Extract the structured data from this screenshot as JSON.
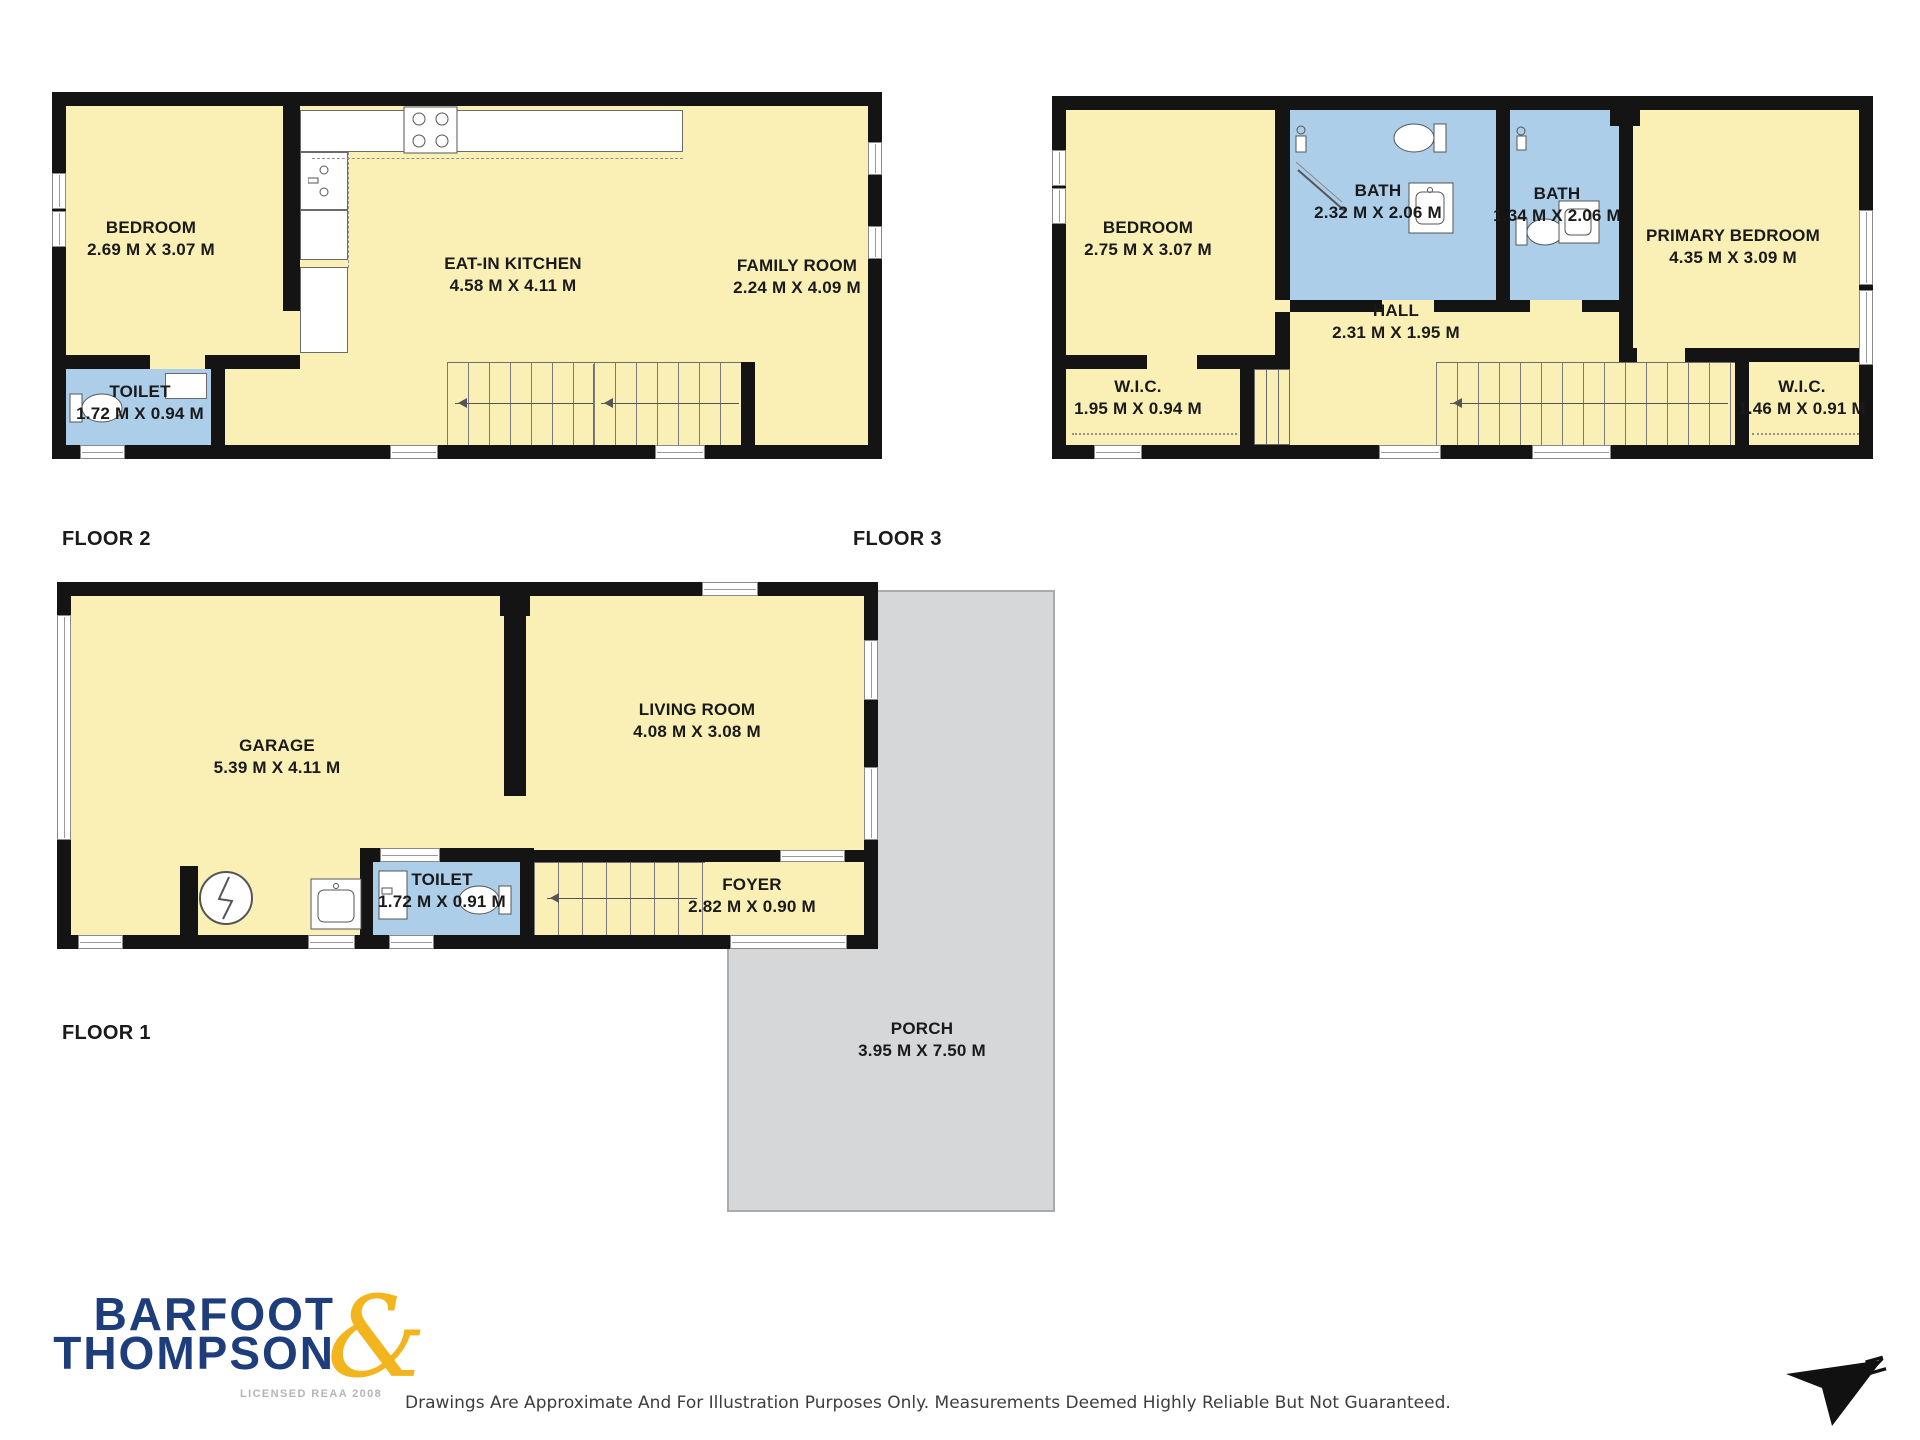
{
  "floor2": {
    "label": "FLOOR 2",
    "bedroom": {
      "name": "BEDROOM",
      "dims": "2.69 M X 3.07 M"
    },
    "kitchen": {
      "name": "EAT-IN KITCHEN",
      "dims": "4.58 M X 4.11 M"
    },
    "family": {
      "name": "FAMILY ROOM",
      "dims": "2.24 M X 4.09 M"
    },
    "toilet": {
      "name": "TOILET",
      "dims": "1.72 M X 0.94 M"
    }
  },
  "floor3": {
    "label": "FLOOR 3",
    "bedroom": {
      "name": "BEDROOM",
      "dims": "2.75 M X 3.07 M"
    },
    "bath1": {
      "name": "BATH",
      "dims": "2.32 M X 2.06 M"
    },
    "bath2": {
      "name": "BATH",
      "dims": "1.34 M X 2.06 M"
    },
    "primary": {
      "name": "PRIMARY BEDROOM",
      "dims": "4.35 M X 3.09 M"
    },
    "hall": {
      "name": "HALL",
      "dims": "2.31 M X 1.95 M"
    },
    "wic_left": {
      "name": "W.I.C.",
      "dims": "1.95 M X 0.94 M"
    },
    "wic_right": {
      "name": "W.I.C.",
      "dims": "1.46 M X 0.91 M"
    }
  },
  "floor1": {
    "label": "FLOOR 1",
    "garage": {
      "name": "GARAGE",
      "dims": "5.39 M X 4.11 M"
    },
    "living": {
      "name": "LIVING ROOM",
      "dims": "4.08 M X 3.08 M"
    },
    "toilet": {
      "name": "TOILET",
      "dims": "1.72 M X 0.91 M"
    },
    "foyer": {
      "name": "FOYER",
      "dims": "2.82 M X 0.90 M"
    },
    "porch": {
      "name": "PORCH",
      "dims": "3.95 M X 7.50 M"
    }
  },
  "branding": {
    "line1": "BARFOOT",
    "line2": "THOMPSON",
    "ampersand": "&",
    "license": "LICENSED REAA 2008"
  },
  "disclaimer": "Drawings Are Approximate And For Illustration Purposes Only. Measurements Deemed Highly Reliable But Not Guaranteed.",
  "compass": {
    "north_label": "N"
  },
  "colors": {
    "room_fill": "#faf0b6",
    "wet_fill": "#accee8",
    "wall": "#141414",
    "porch_fill": "#d6d7d9",
    "porch_border": "#a9abad",
    "logo_navy": "#1e3d7b",
    "logo_gold": "#f2b51d",
    "license_gray": "#b5b5b5",
    "text": "#1a1a1a",
    "disclaimer_text": "#3d3d3d"
  }
}
